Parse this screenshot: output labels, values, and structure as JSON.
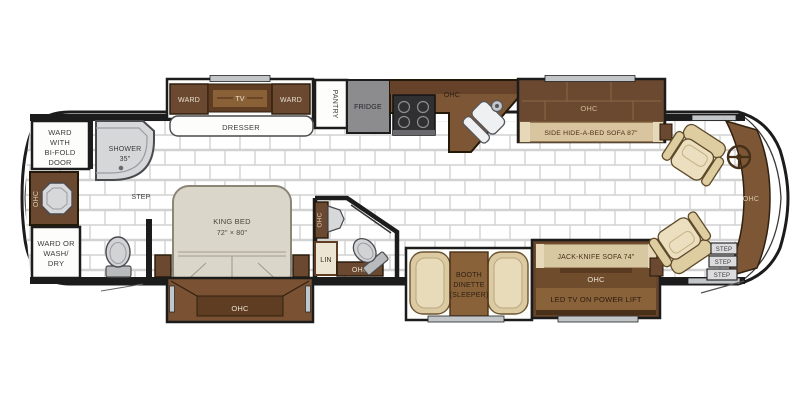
{
  "palette": {
    "wall": "#1c1c1c",
    "tile_line": "#d2d2d2",
    "cabinet_dark_brown": "#6b4830",
    "cabinet_mid_brown": "#7d5636",
    "cabinet_light_brown": "#8a6239",
    "sofa_tan": "#d8c49e",
    "chair_tan": "#dfcda2",
    "bed_beige": "#dbd6ca",
    "fixture_gray": "#d2d3d5",
    "fridge_gray": "#8c8c8e",
    "stove_black": "#303032",
    "window_gray": "#c3c6c9",
    "label_dark": "#3c3c3c",
    "label_light": "#e9e0cf"
  },
  "rear_bath": {
    "ward_bifold": [
      "WARD",
      "WITH",
      "BI-FOLD",
      "DOOR"
    ],
    "shower": [
      "SHOWER",
      "35\""
    ],
    "ohc_vertical": "OHC",
    "ward_washdry": [
      "WARD OR",
      "WASH/",
      "DRY"
    ],
    "step": "STEP"
  },
  "bedroom": {
    "ward_left": "WARD",
    "tv": "TV",
    "ward_right": "WARD",
    "dresser": "DRESSER",
    "king_bed": [
      "KING BED",
      "72\" × 80\""
    ],
    "bed_ohc": "OHC"
  },
  "mid_bath": {
    "ohc_vertical": "OHC",
    "lin": "LIN",
    "ohc": "OHC"
  },
  "kitchen": {
    "pantry": "PANTRY",
    "fridge": "FRIDGE",
    "ohc": "OHC"
  },
  "living": {
    "sofa_ohc": "OHC",
    "hide_a_bed": "SIDE HIDE-A-BED SOFA 87\"",
    "dinette": [
      "BOOTH",
      "DINETTE",
      "(SLEEPER)"
    ],
    "jack_knife": "JACK-KNIFE SOFA 74\"",
    "jack_knife_ohc": "OHC",
    "tv_lift": "LED TV ON POWER LIFT"
  },
  "cockpit": {
    "dash_ohc": "OHC",
    "steps": [
      "STEP",
      "STEP",
      "STEP"
    ]
  }
}
